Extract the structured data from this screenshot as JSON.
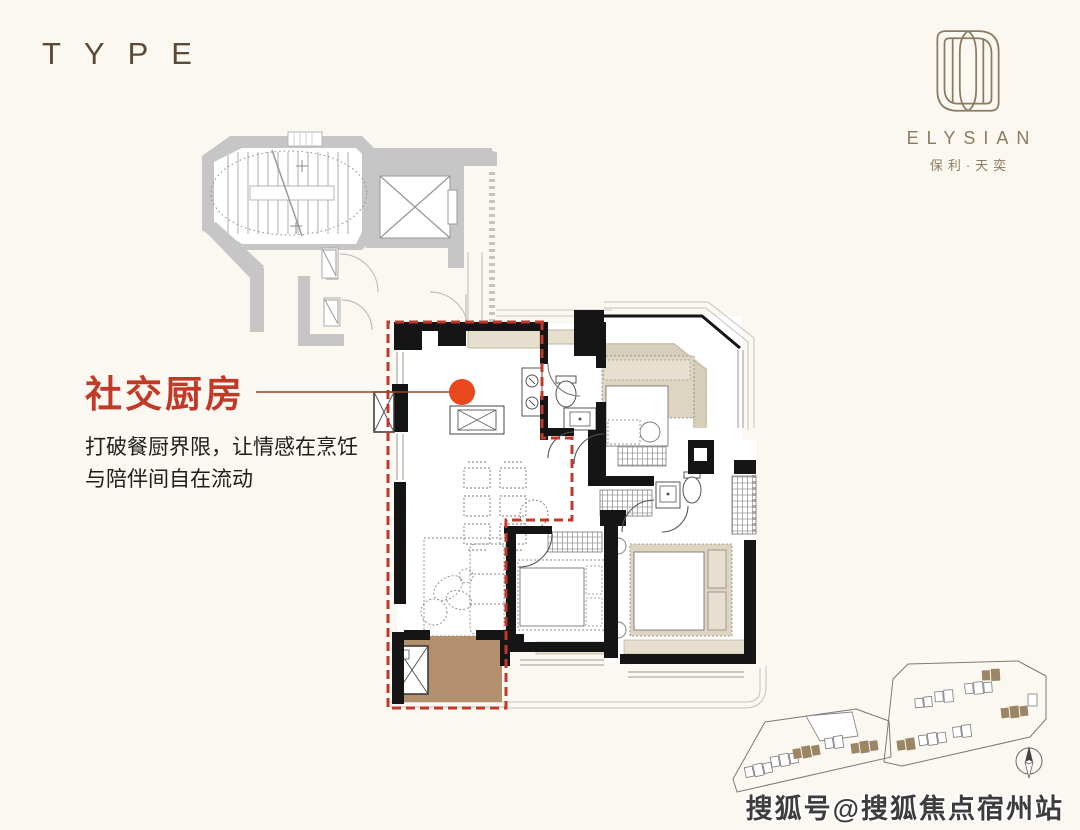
{
  "page": {
    "background_color": "#fbf8f1"
  },
  "header": {
    "type_label": "TYPE",
    "color": "#5d4a36"
  },
  "brand": {
    "logo_icon": "elysian-emblem",
    "name_en": "ELYSIAN",
    "name_cn": "保利·天奕",
    "color": "#8c7a63"
  },
  "callout": {
    "title": "社交厨房",
    "title_color": "#c13a28",
    "description_line1": "打破餐厨界限，让情感在烹饪",
    "description_line2": "与陪伴间自在流动"
  },
  "floor_plan": {
    "highlight_label": "社交厨房",
    "highlight_outline_color": "#c0392b",
    "marker_dot_color": "#e8481c",
    "wall_color": "#151515",
    "core_wall_color": "#c6c6c6",
    "furniture_fill_color": "#ded5c1",
    "balcony_fill_color": "#b2906d"
  },
  "site_plan": {
    "compass_icon": "north-compass",
    "building_highlight_color": "#9c8565"
  },
  "watermark": {
    "text": "搜狐号@搜狐焦点宿州站"
  }
}
